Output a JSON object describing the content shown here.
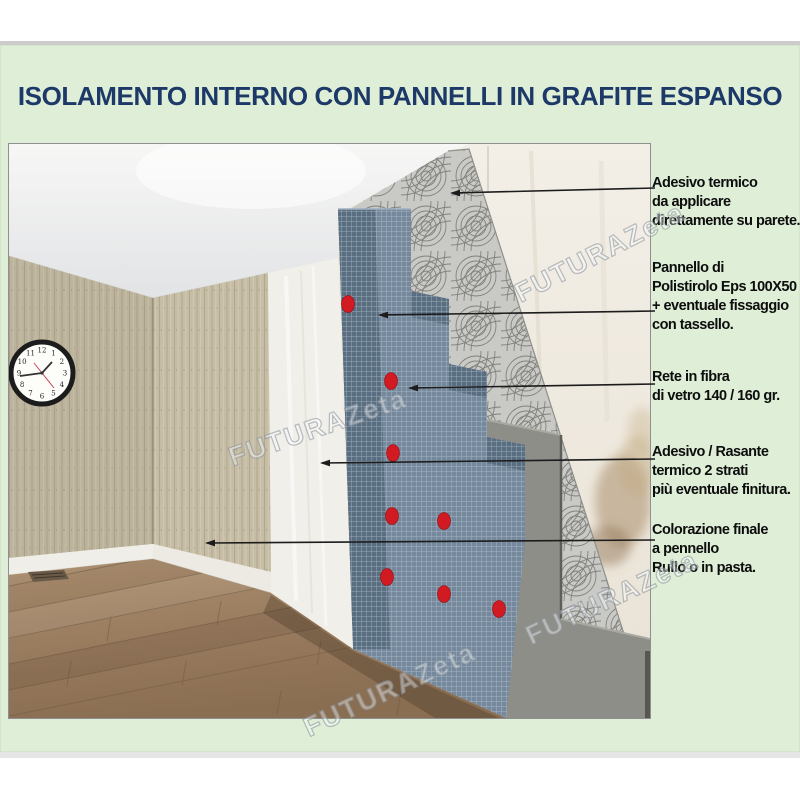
{
  "title": {
    "text": "ISOLAMENTO INTERNO CON PANNELLI IN GRAFITE ESPANSO"
  },
  "callouts": [
    {
      "id": "adesivo-termico",
      "lines": [
        "Adesivo termico",
        "da applicare",
        "direttamente su parete."
      ]
    },
    {
      "id": "pannello-eps",
      "lines": [
        "Pannello di",
        "Polistirolo Eps 100X50",
        "+ eventuale fissaggio",
        "con tassello."
      ]
    },
    {
      "id": "rete-fibra",
      "lines": [
        "Rete in fibra",
        "di vetro 140 / 160 gr."
      ]
    },
    {
      "id": "adesivo-rasante",
      "lines": [
        "Adesivo / Rasante",
        "termico 2 strati",
        "più eventuale finitura."
      ]
    },
    {
      "id": "colorazione",
      "lines": [
        "Colorazione finale",
        "a pennello",
        "Rullo o in pasta."
      ]
    }
  ],
  "watermark": {
    "text": "FUTURAZeta"
  },
  "clock": {
    "numbers": [
      "12",
      "1",
      "2",
      "3",
      "4",
      "5",
      "6",
      "7",
      "8",
      "9",
      "10",
      "11"
    ]
  },
  "colors": {
    "canvas_green": "#dfeed7",
    "title_navy": "#1d3967",
    "label_text": "#0d0d0d",
    "arrow_black": "#1c1c1c",
    "dowel_red": "#d11a22",
    "mesh_blue": "#75889c",
    "eps_edge_blue": "#5a6e81",
    "skim_gray": "#8e8e88",
    "adhesive_swirl_gray": "#c9c9c6",
    "bare_wall": "#efe9df",
    "stain_brown": "#a98e6b",
    "slat_wall_beige": "#c6bda6",
    "baseboard_white": "#efeee8",
    "wood_floor_brown": "#9a7c5f",
    "ceiling_white": "#f4f4f4"
  }
}
